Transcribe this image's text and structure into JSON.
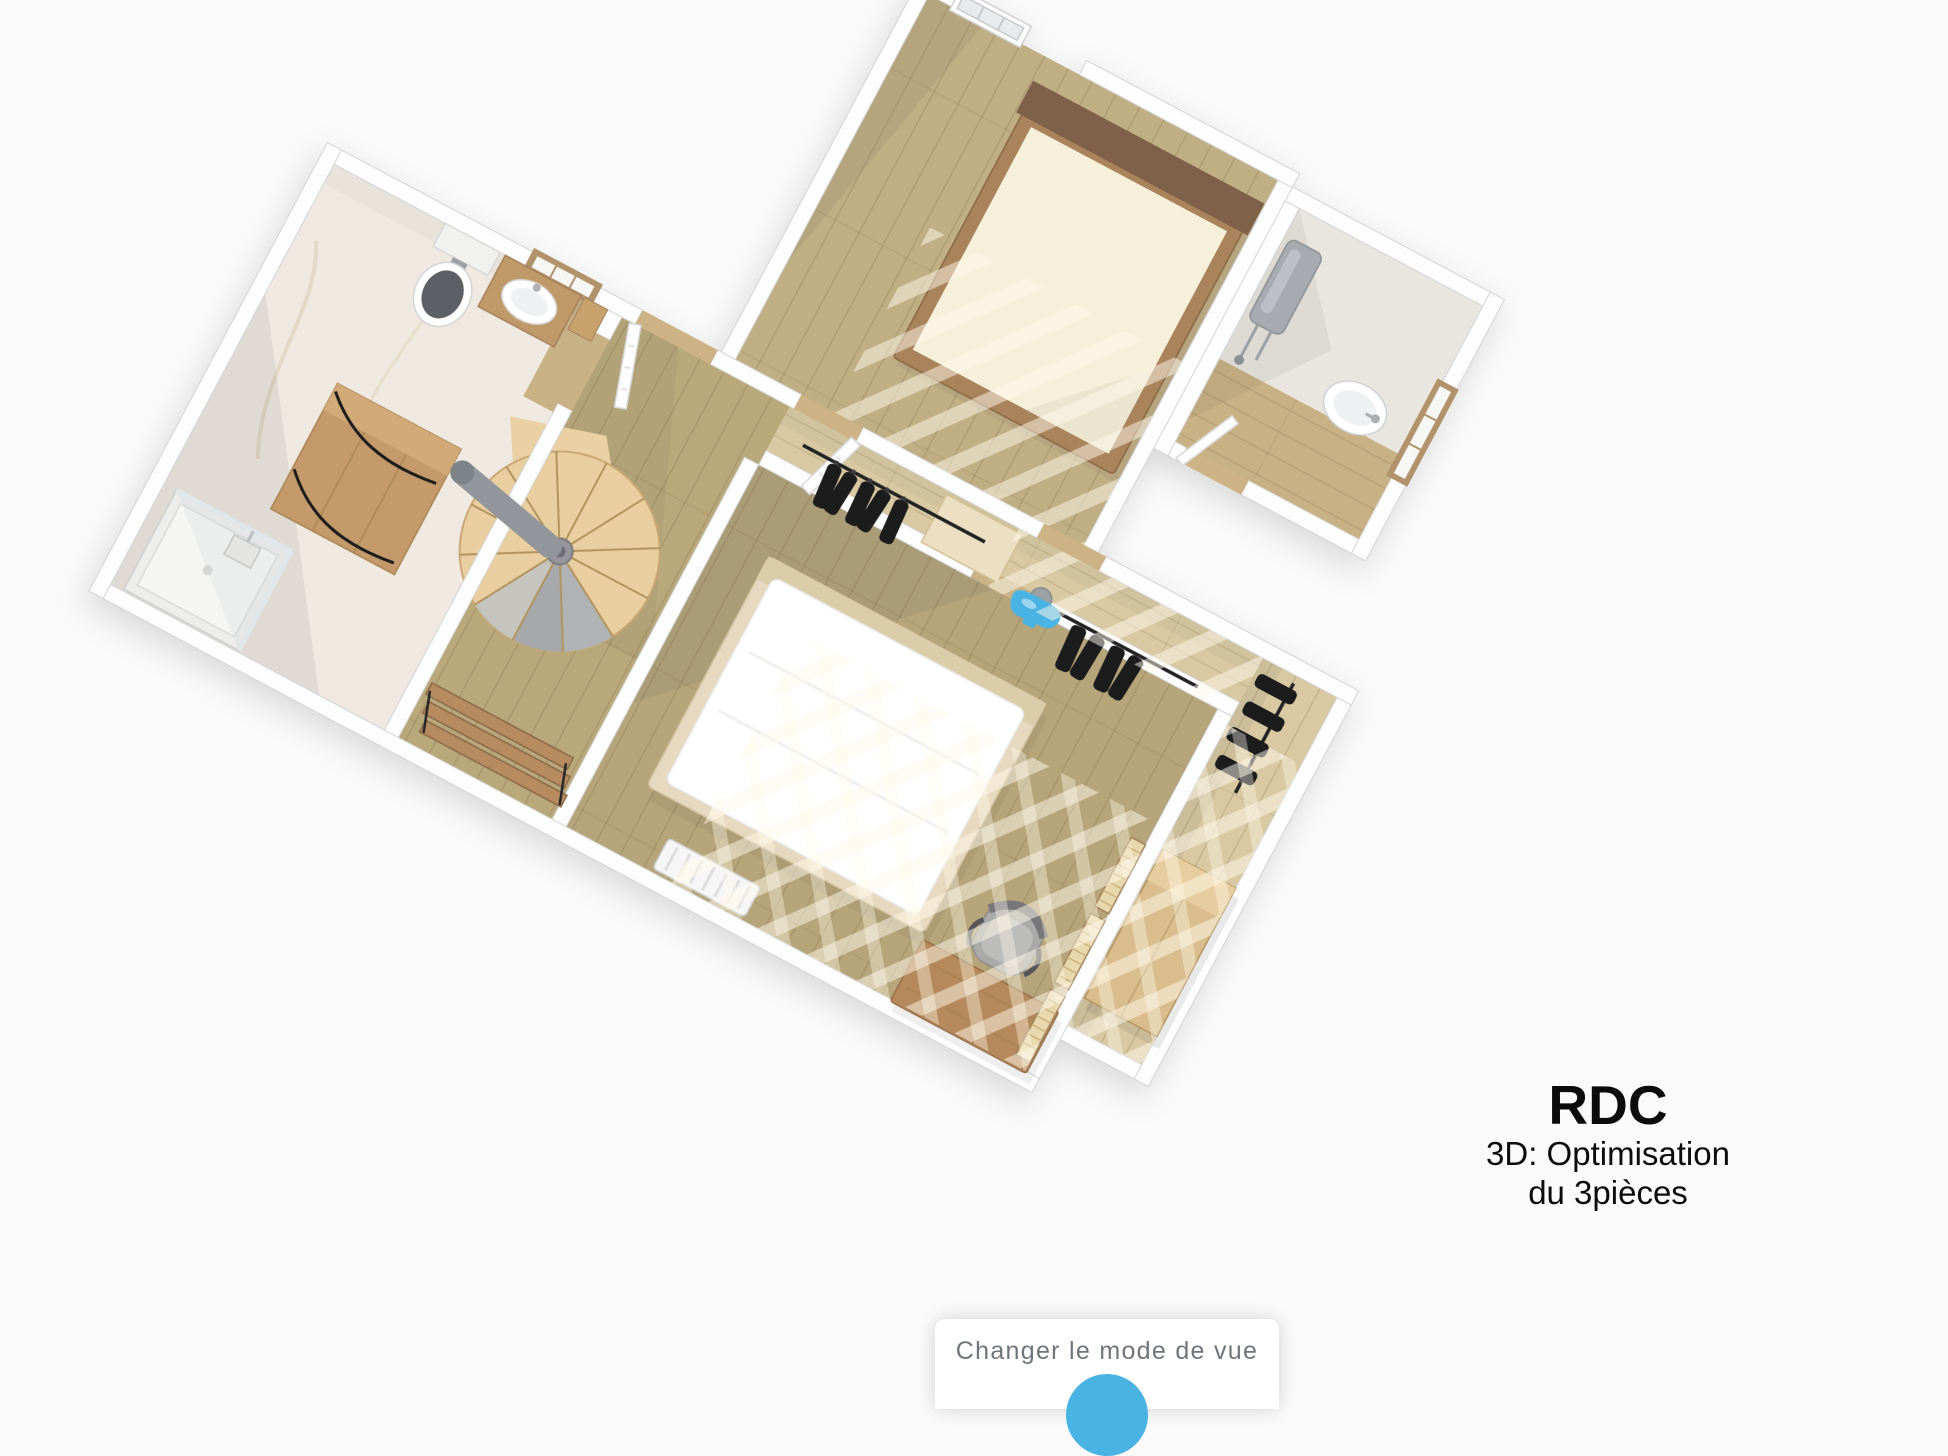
{
  "caption": {
    "title": "RDC",
    "subtitle_line1": "3D: Optimisation",
    "subtitle_line2": "du 3pièces"
  },
  "view_mode_panel": {
    "label": "Changer le mode de vue",
    "toggle_color": "#49b3e3"
  },
  "floorplan": {
    "type": "3d-floorplan-top-view",
    "rotation_deg": 28,
    "rooms": [
      "bathroom",
      "hallway-landing",
      "bedroom-top",
      "wc-laundry",
      "bedroom-main",
      "dressing"
    ],
    "objects": [
      "spiral-staircase",
      "handrail",
      "double-bed-top",
      "double-bed-main",
      "toilet",
      "vanity-sink",
      "shower",
      "bathroom-cabinet",
      "shelf-unit",
      "clothes-rail",
      "hanging-clothes",
      "wardrobe",
      "louvered-shutters",
      "desk",
      "desk-chair",
      "radiator",
      "water-heater",
      "washbasin",
      "window",
      "door",
      "wall-faucet-marker"
    ],
    "colors": {
      "wood_floor": "#b6a57a",
      "light_wood": "#d8c9a2",
      "stairs_wood": "#e9cf9f",
      "wall": "#fdfdfd",
      "marble": "#efe9e1",
      "accent_blue": "#49b3e3"
    }
  }
}
